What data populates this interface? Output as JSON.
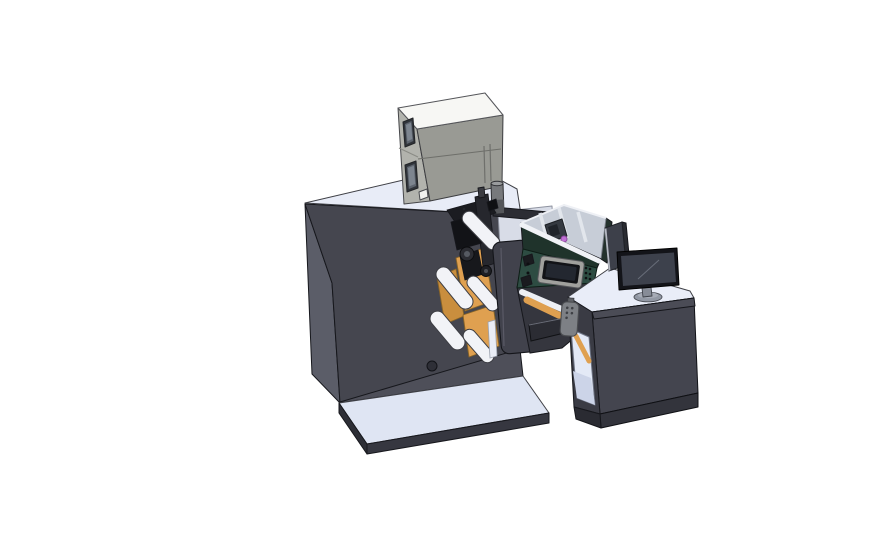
{
  "scene": {
    "type": "3d-cad-render",
    "description": "Isometric CAD render of a label printing and rewinding machine line with electrical cabinet, print mechanism, web rollers, inspection unit with HMI screen, pendant control and an operator desk with monitor",
    "background": "#ffffff"
  },
  "palette": {
    "background": "#ffffff",
    "outline": "#16171c",
    "machine_front": "#45464f",
    "machine_side": "#5b5d68",
    "machine_top": "#e8ecf7",
    "machine_apron": "#4e4f59",
    "platform_top": "#dfe5f3",
    "platform_front": "#363740",
    "platform_side": "#2d2e36",
    "cabinet_top": "#f7f7f4",
    "cabinet_front": "#999a94",
    "cabinet_side": "#b2b3ad",
    "cabinet_window": "#5d646e",
    "cabinet_window_inner": "#7d858f",
    "vent_line": "#6f706c",
    "exhaust_gray": "#77797c",
    "exhaust_dark": "#54565a",
    "black_part": "#1b1c21",
    "black_part_dark": "#121317",
    "column_dark": "#26272d",
    "orange_web": "#dfa050",
    "orange_deep": "#c98e3e",
    "roller_white": "#f2f3f7",
    "flip_panel": "#41424c",
    "gap_face": "#d8dce7",
    "beam_dark": "#2b2c33",
    "green_front": "#2d4c42",
    "green_bevel": "#1f332b",
    "green_right": "#24322d",
    "interior_light": "#c7cdd7",
    "rib_light": "#e2e6ec",
    "magenta": "#c06fd4",
    "hmi_frame": "#a0a09d",
    "hmi_bezel": "#121317",
    "hmi_screen": "#232730",
    "under_dark": "#35363e",
    "rail_white": "#edeff4",
    "pendant_gray": "#7d8085",
    "desk_front": "#44454f",
    "desk_band": "#4b4c56",
    "desk_side": "#3a3b44",
    "desk_top": "#e9edf8",
    "desk_plinth": "#33343c",
    "compartment_light": "#e3e9f6",
    "compartment_floor": "#ccd4e8",
    "divider_panel": "#3d404a",
    "divider_edge": "#b6bac4",
    "monitor_bezel": "#131419",
    "monitor_screen": "#3d414c",
    "stand_gray": "#9298a4"
  },
  "parts": [
    {
      "id": "machine-body",
      "label": "main machine body",
      "color": "machine_front"
    },
    {
      "id": "base-platform",
      "label": "base platform",
      "color": "platform_top"
    },
    {
      "id": "electrical-cabinet",
      "label": "electrical cabinet on top",
      "color": "cabinet_front"
    },
    {
      "id": "exhaust-cylinder",
      "label": "exhaust cylinder",
      "color": "exhaust_gray"
    },
    {
      "id": "print-mechanism",
      "label": "print head mechanism",
      "color": "black_part"
    },
    {
      "id": "web-rollers",
      "label": "white web rollers",
      "color": "roller_white"
    },
    {
      "id": "orange-web",
      "label": "orange label web",
      "color": "orange_web"
    },
    {
      "id": "flip-door-panel",
      "label": "hinged access door",
      "color": "flip_panel"
    },
    {
      "id": "green-rewinder-unit",
      "label": "inspection / rewinder unit",
      "color": "green_front"
    },
    {
      "id": "hmi-screen",
      "label": "HMI operator screen",
      "color": "hmi_screen"
    },
    {
      "id": "bridge-conveyor",
      "label": "bridge conveyor beam",
      "color": "beam_dark"
    },
    {
      "id": "pendant-remote",
      "label": "pendant control",
      "color": "pendant_gray"
    },
    {
      "id": "operator-desk",
      "label": "operator desk cabinet",
      "color": "desk_front"
    },
    {
      "id": "divider-panel",
      "label": "side divider panel",
      "color": "divider_panel"
    },
    {
      "id": "monitor",
      "label": "desktop monitor",
      "color": "monitor_screen"
    }
  ]
}
